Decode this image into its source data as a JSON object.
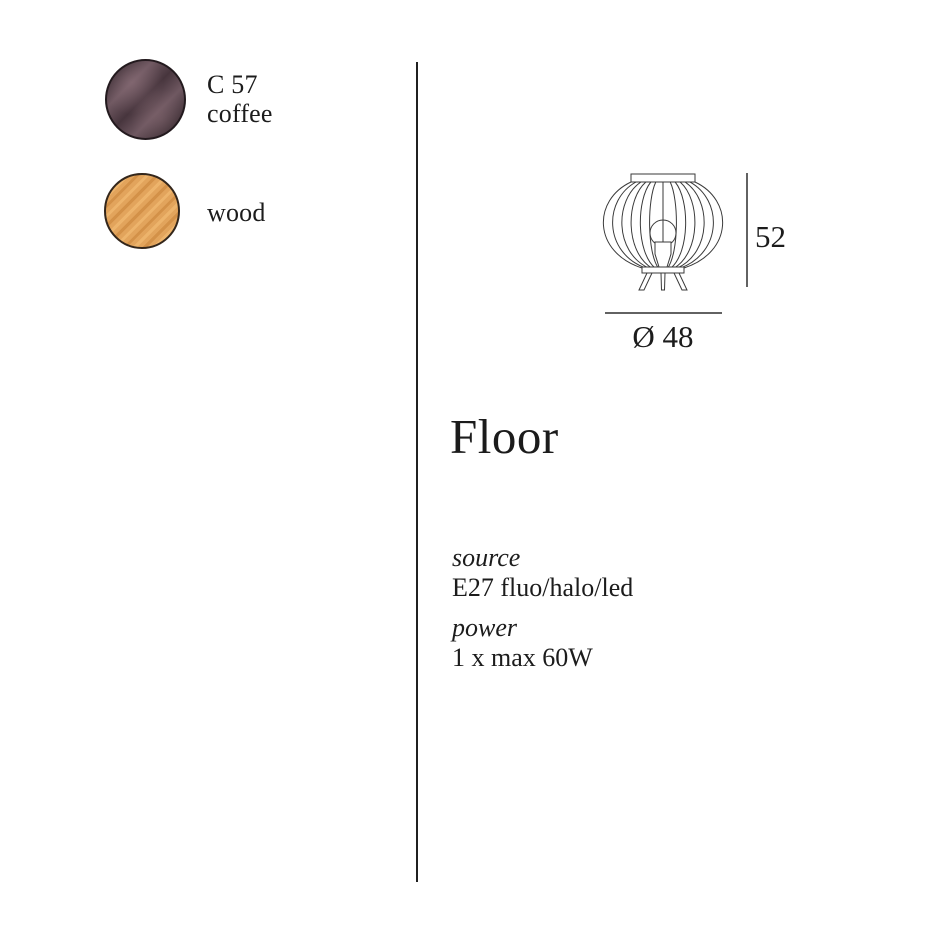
{
  "swatches": {
    "coffee": {
      "code": "C 57",
      "name": "coffee",
      "base_color": "#47353d",
      "light_color": "#6f5861",
      "dark_color": "#2c2026"
    },
    "wood": {
      "name": "wood",
      "base_color": "#e2a45c",
      "light_color": "#edb46c",
      "dark_color": "#d39148"
    }
  },
  "product": {
    "title": "Floor",
    "source_label": "source",
    "source_value": "E27 fluo/halo/led",
    "power_label": "power",
    "power_value": "1 x max 60W"
  },
  "diagram": {
    "height": "52",
    "diameter": "Ø 48",
    "stroke_color": "#3a3a3a",
    "line_color": "#2e2e2e"
  }
}
